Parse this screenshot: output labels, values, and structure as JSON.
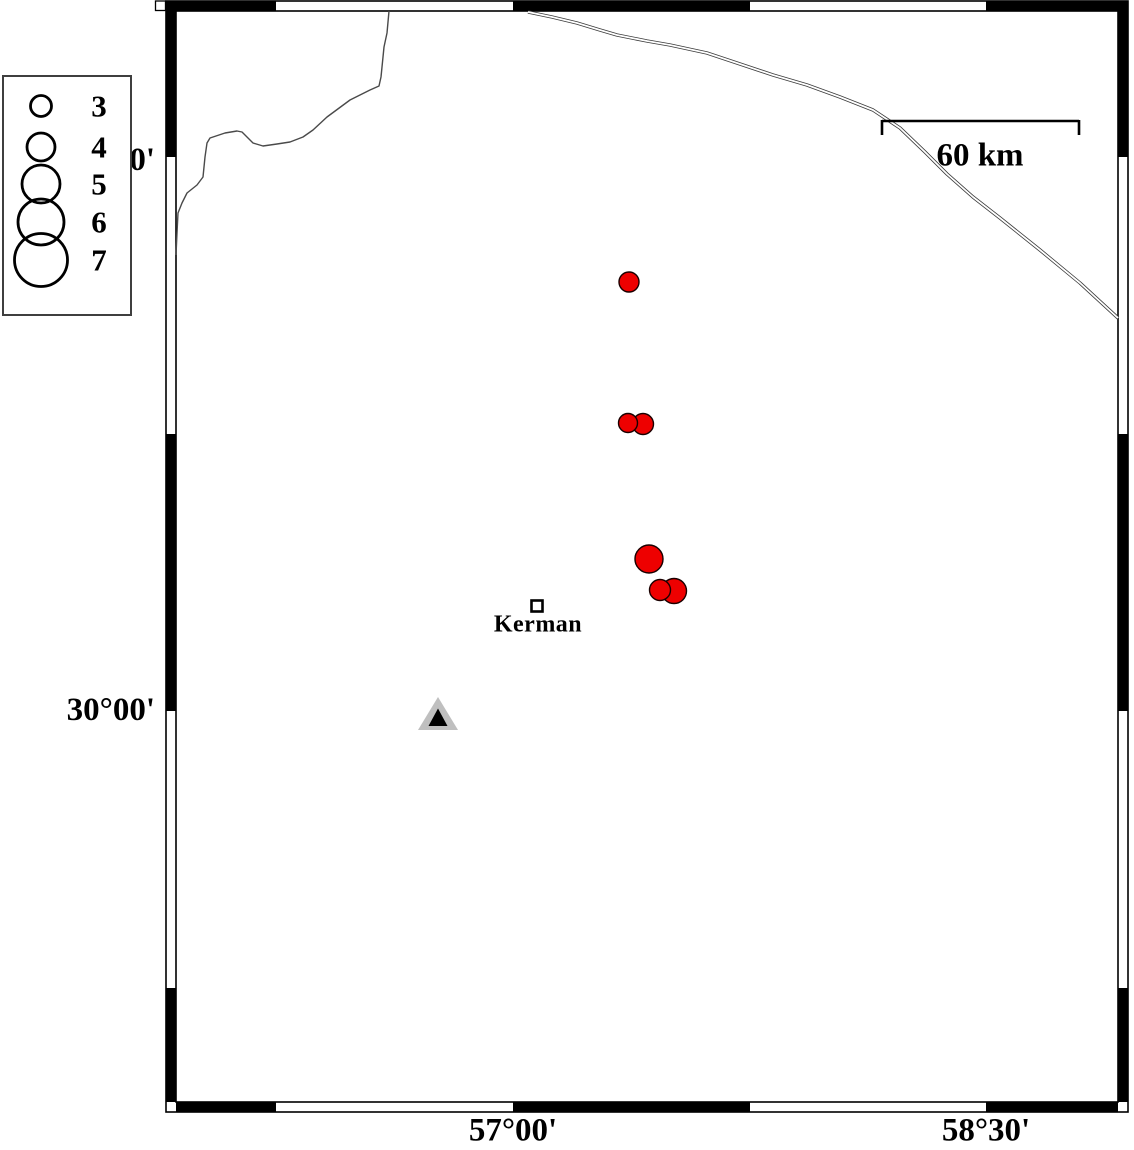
{
  "map": {
    "city": {
      "label": "Kerman",
      "x": 538,
      "y": 625,
      "marker": {
        "x": 537,
        "y": 606
      }
    },
    "scalebar": {
      "label": "60 km",
      "label_x": 980,
      "label_y": 156,
      "x1": 882,
      "x2": 1079,
      "y": 121
    },
    "annotations": {
      "lat": [
        {
          "label": "31°30'",
          "x": 155,
          "y": 161
        },
        {
          "label": "30°00'",
          "x": 155,
          "y": 711
        }
      ],
      "lon": [
        {
          "label": "57°00'",
          "x": 513,
          "y": 1131
        },
        {
          "label": "58°30'",
          "x": 986,
          "y": 1131
        }
      ]
    },
    "colors": {
      "earthquake_fill": "#ee0000",
      "earthquake_stroke": "#1a0000",
      "station_outer": "#bfbfbf",
      "station_inner": "#000000"
    },
    "earthquakes": [
      {
        "x": 629,
        "y": 282,
        "r": 10.0
      },
      {
        "x": 643,
        "y": 424,
        "r": 10.5
      },
      {
        "x": 628,
        "y": 423,
        "r": 9.5
      },
      {
        "x": 649,
        "y": 559,
        "r": 14.0
      },
      {
        "x": 674,
        "y": 591,
        "r": 12.5
      },
      {
        "x": 660,
        "y": 590,
        "r": 10.5
      }
    ],
    "station": {
      "x": 438,
      "y": 715
    }
  },
  "legend": {
    "entries": [
      {
        "label": "3",
        "r": 10.5,
        "cy": 29
      },
      {
        "label": "4",
        "r": 14.0,
        "cy": 70
      },
      {
        "label": "5",
        "r": 19.0,
        "cy": 107
      },
      {
        "label": "6",
        "r": 23.0,
        "cy": 145
      },
      {
        "label": "7",
        "r": 26.5,
        "cy": 183
      }
    ]
  }
}
